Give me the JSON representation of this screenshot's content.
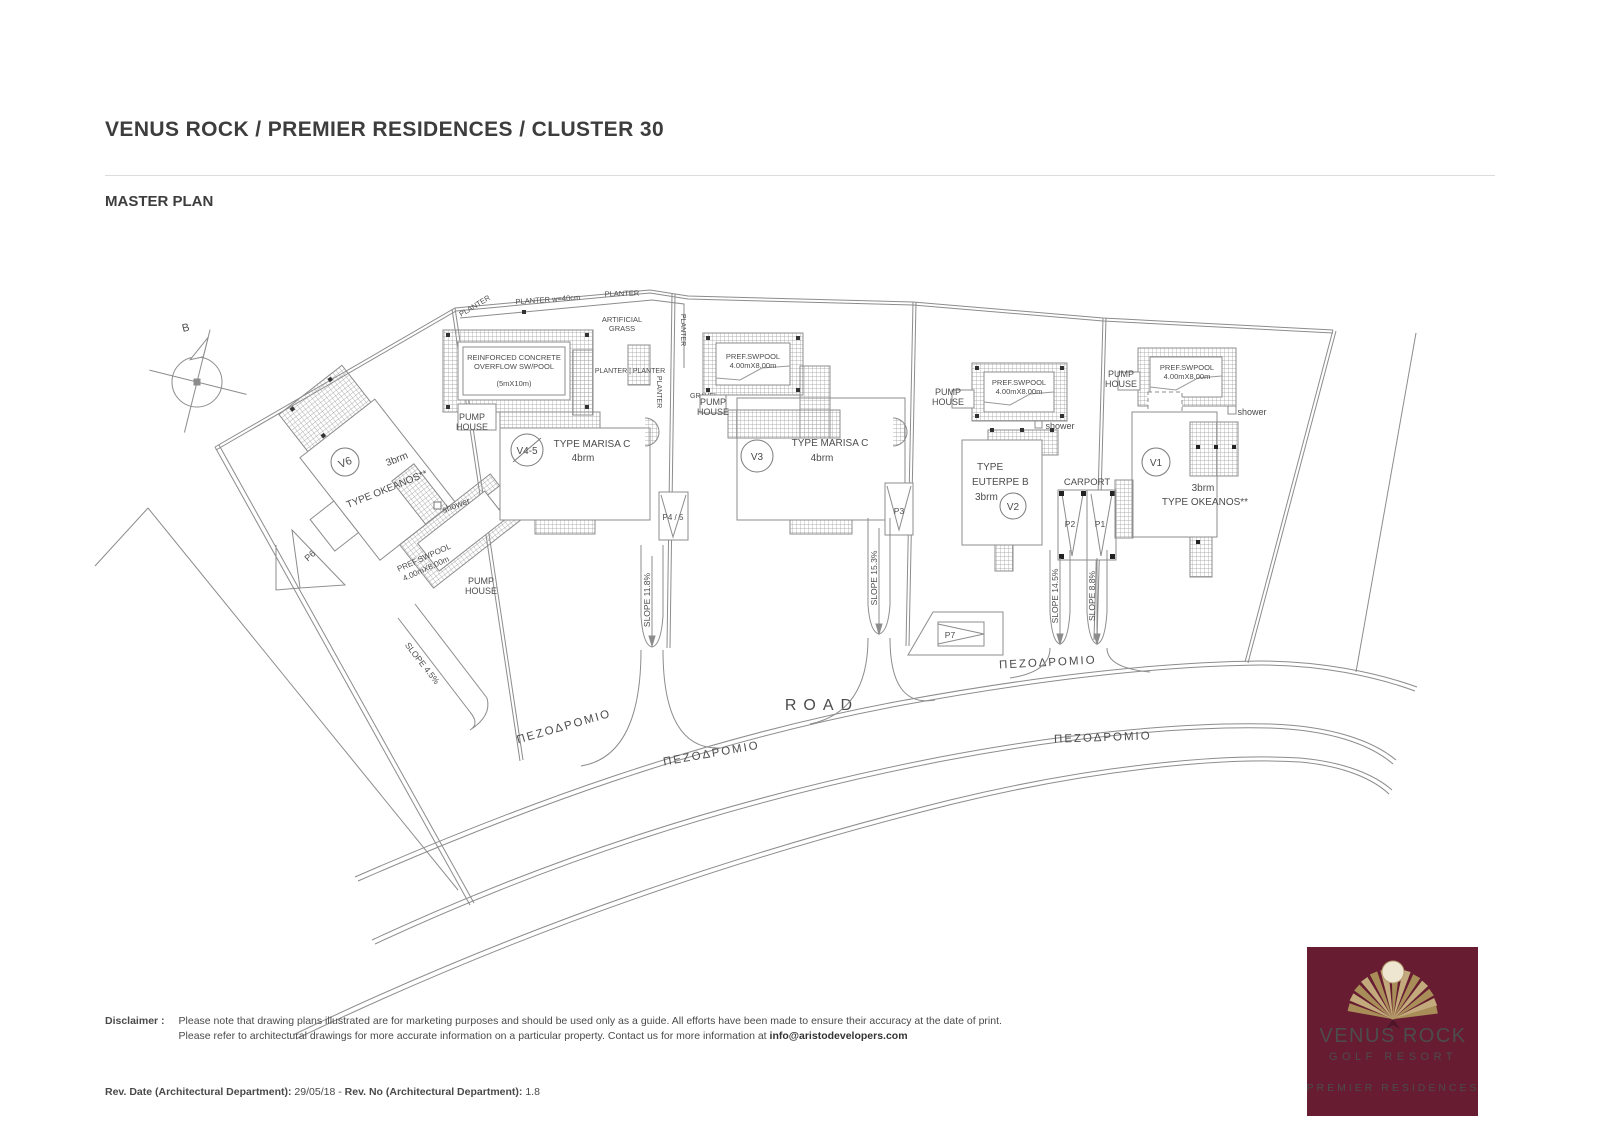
{
  "header": {
    "title": "VENUS ROCK / PREMIER RESIDENCES / CLUSTER 30",
    "subtitle": "MASTER PLAN"
  },
  "plan": {
    "compass": "B",
    "road_label": "ROAD",
    "sidewalk": "ΠΕΖΟΔΡΟΜΙΟ",
    "labels": {
      "pump1": "PUMP",
      "pump2": "HOUSE",
      "shower": "shower",
      "pool1": "PREF.SWPOOL",
      "pool2": "4.00mX8.00m",
      "cpool1": "REINFORCED CONCRETE",
      "cpool2": "OVERFLOW SW/POOL",
      "cpool3": "(5mX10m)",
      "grass1": "ARTIFICIAL",
      "grass2": "GRASS",
      "planter": "PLANTER",
      "planter_w": "PLANTER w=40cm",
      "planter_pair": "PLANTER | PLANTER",
      "gravel": "GRAVEL",
      "carport": "CARPORT"
    },
    "villas": [
      {
        "id": "V6",
        "brm": "3brm",
        "type": "TYPE OKEANOS**"
      },
      {
        "id": "V4-5",
        "brm": "4brm",
        "type": "TYPE MARISA C"
      },
      {
        "id": "V3",
        "brm": "4brm",
        "type": "TYPE MARISA C"
      },
      {
        "id": "V2",
        "brm": "3brm",
        "type_l1": "TYPE",
        "type_l2": "EUTERPE B"
      },
      {
        "id": "V1",
        "brm": "3brm",
        "type": "TYPE OKEANOS**"
      }
    ],
    "parking": {
      "p1": "P1",
      "p2": "P2",
      "p3": "P3",
      "p45": "P4 / 5",
      "p6": "P6",
      "p7": "P7"
    },
    "slopes": {
      "s45": "SLOPE 4.5%",
      "s118": "SLOPE 11.8%",
      "s153": "SLOPE 15.3%",
      "s145": "SLOPE 14.5%",
      "s88": "SLOPE 8.8%"
    }
  },
  "footer": {
    "disclaimer_label": "Disclaimer :",
    "line1": "Please note that drawing plans illustrated are for marketing purposes and should be used only as a guide. All efforts have been made to ensure their accuracy at the date of print.",
    "line2_pre": "Please refer to architectural drawings for more accurate information on a particular property. Contact us for more information at ",
    "email": "info@aristodevelopers.com",
    "rev_label1": "Rev. Date (Architectural Department):",
    "rev_value1": " 29/05/18 - ",
    "rev_label2": "Rev. No (Architectural Department):",
    "rev_value2": " 1.8"
  },
  "logo": {
    "brand": "VENUS ROCK",
    "sub": "GOLF RESORT",
    "tagline": "PREMIER RESIDENCES",
    "bg": "#671c31",
    "gold": "#bb9d68"
  }
}
